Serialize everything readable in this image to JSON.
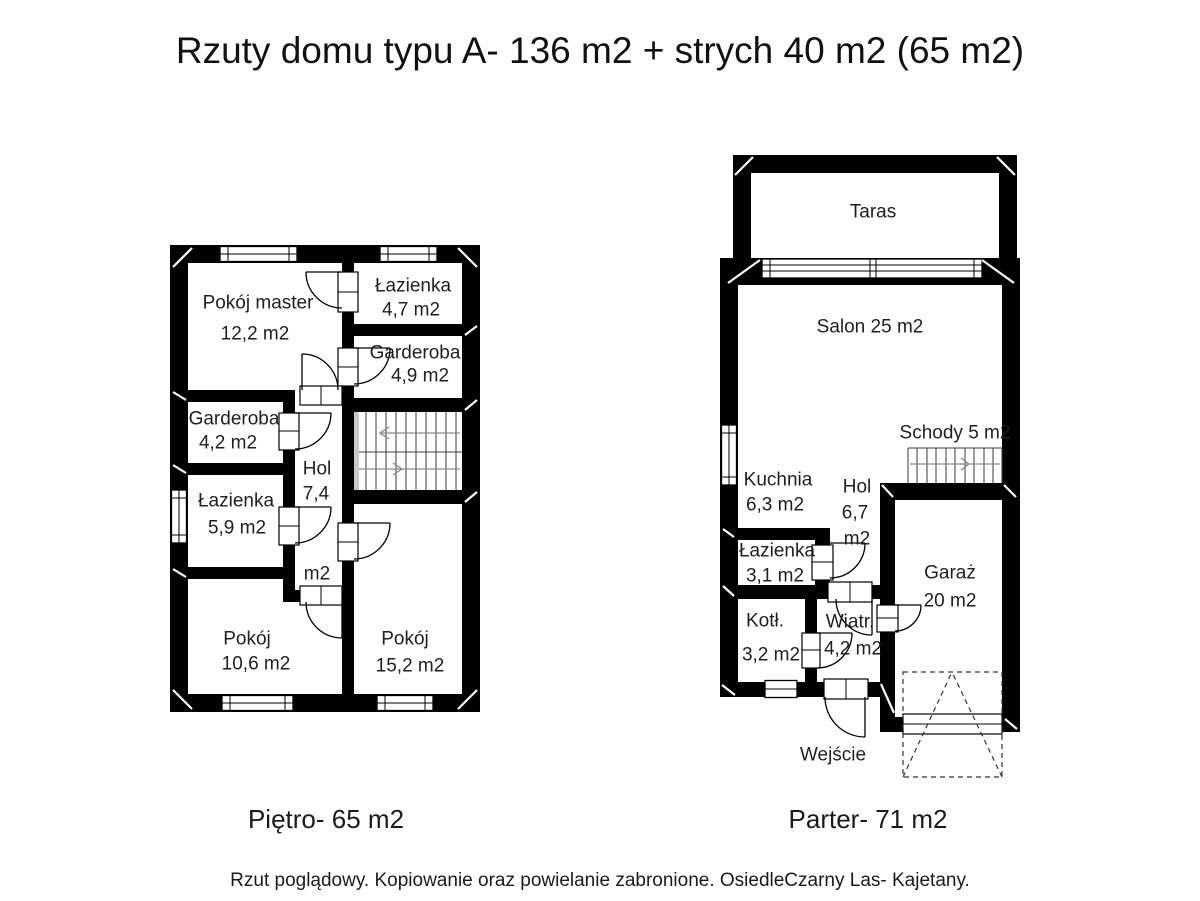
{
  "title": "Rzuty domu typu A- 136 m2 + strych 40 m2 (65 m2)",
  "footer": "Rzut poglądowy. Kopiowanie oraz powielanie zabronione. OsiedleCzarny Las- Kajetany.",
  "colors": {
    "wall": "#000000",
    "background": "#ffffff",
    "text": "#1a1a1a",
    "stair_rail": "#8a8a8a"
  },
  "floor_upper": {
    "label": "Piętro- 65 m2",
    "rooms": {
      "master": {
        "name": "Pokój master",
        "area": "12,2 m2"
      },
      "lazienka_top": {
        "name": "Łazienka",
        "area": "4,7 m2"
      },
      "garderoba_right": {
        "name": "Garderoba",
        "area": "4,9 m2"
      },
      "garderoba_left": {
        "name": "Garderoba",
        "area": "4,2 m2"
      },
      "lazienka_left": {
        "name": "Łazienka",
        "area": "5,9 m2"
      },
      "hol": {
        "name": "Hol",
        "area": "7,4",
        "unit": "m2"
      },
      "pokoj_small": {
        "name": "Pokój",
        "area": "10,6 m2"
      },
      "pokoj_large": {
        "name": "Pokój",
        "area": "15,2 m2"
      }
    }
  },
  "floor_ground": {
    "label": "Parter- 71 m2",
    "rooms": {
      "taras": {
        "name": "Taras"
      },
      "salon": {
        "name": "Salon 25 m2"
      },
      "schody": {
        "name": "Schody 5 m2"
      },
      "kuchnia": {
        "name": "Kuchnia",
        "area": "6,3 m2"
      },
      "hol": {
        "name": "Hol",
        "area": "6,7",
        "unit": "m2"
      },
      "lazienka": {
        "name": "Łazienka",
        "area": "3,1 m2"
      },
      "garaz": {
        "name": "Garaż",
        "area": "20 m2"
      },
      "kotl": {
        "name": "Kotł.",
        "area": "3,2 m2"
      },
      "wiatr": {
        "name": "Wiatr.",
        "area": "4,2 m2"
      },
      "wejscie": {
        "name": "Wejście"
      }
    }
  }
}
